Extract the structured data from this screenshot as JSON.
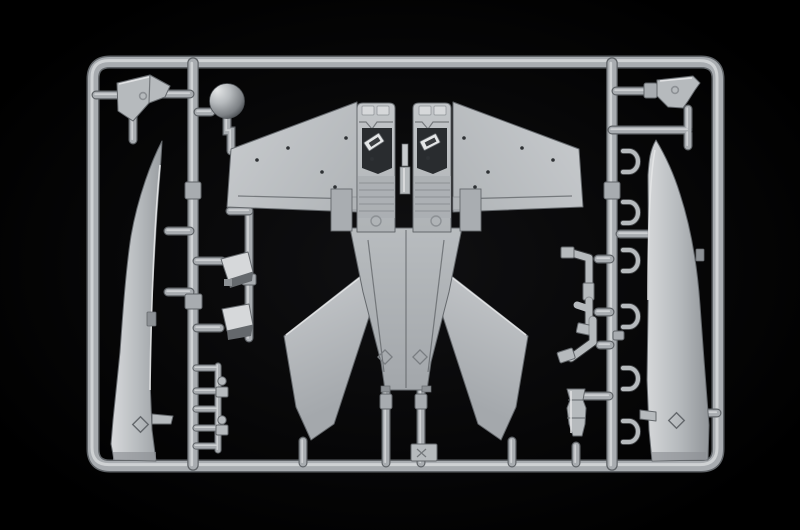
{
  "meta": {
    "title": "Model kit sprue photograph",
    "subject": "Light grey injection-moulded plastic sprue (runner frame) holding the parts of a jet-fighter model kit, photographed on a black background",
    "width_px": 800,
    "height_px": 530
  },
  "colors": {
    "background": "#000000",
    "background_center": "#101012",
    "tube_mid": "#a8acb0",
    "tube_hi": "#d3d6d8",
    "tube_dark": "#5f6367",
    "part_mid": "#b6babd",
    "part_hi": "#d6d8da",
    "part_hi2": "#e4e6e7",
    "part_sh": "#8d9195",
    "part_dark": "#64686c",
    "crevice": "#3a3d40",
    "cockpit_dark": "#292c2f",
    "dot_dark": "#2e3134"
  },
  "scene": {
    "material": "light grey polystyrene plastic",
    "backdrop": "black studio backdrop",
    "parts": [
      {
        "name": "sprue-frame",
        "description": "rounded rectangular outer runner frame"
      },
      {
        "name": "left-inner-runner",
        "description": "vertical runner bar on the left third"
      },
      {
        "name": "right-inner-runner",
        "description": "vertical runner bar on the right third"
      },
      {
        "name": "radome-ball",
        "description": "spherical nose radome part near top left"
      },
      {
        "name": "windscreen-part-left",
        "description": "angular windscreen/nose-cap part, top left"
      },
      {
        "name": "windscreen-part-right",
        "description": "angular windscreen/nose-cap part, top right"
      },
      {
        "name": "fuselage-side-left",
        "description": "long tapered fuselage side half running down the left edge"
      },
      {
        "name": "fuselage-side-right",
        "description": "long tapered fuselage side half running down the right edge"
      },
      {
        "name": "main-wing-left",
        "description": "large left wing panel of the central assembly"
      },
      {
        "name": "main-wing-right",
        "description": "large right wing panel of the central assembly"
      },
      {
        "name": "fuselage-half-left",
        "description": "central fuselage half with moulded cockpit detail"
      },
      {
        "name": "fuselage-half-right",
        "description": "central fuselage half with moulded cockpit detail"
      },
      {
        "name": "lower-fuselage",
        "description": "joined tapering rear fuselage with twin sprue stems"
      },
      {
        "name": "tail-fin-left",
        "description": "swept tail surface angled down-left"
      },
      {
        "name": "tail-fin-right",
        "description": "swept tail surface angled down-right"
      },
      {
        "name": "intake-scoop-upper",
        "description": "small box-like intake scoop part"
      },
      {
        "name": "intake-scoop-lower",
        "description": "small box-like intake scoop part"
      },
      {
        "name": "ladder-subassembly",
        "description": "ladder-like runner with five rungs and small fittings, bottom left"
      },
      {
        "name": "landing-gear-struts",
        "description": "cluster of small undercarriage strut parts left of the right runner"
      },
      {
        "name": "canopy-frame-clips",
        "description": "column of small open bracket parts on the right runner"
      },
      {
        "name": "exhaust-nozzle-part",
        "description": "small waisted nozzle part near bottom right of centre"
      },
      {
        "name": "molded-tag",
        "description": "small embossed tag plate beside the centre tail stem"
      }
    ],
    "counts": {
      "canopy_frame_clips": 6,
      "ladder_rungs": 5,
      "wing_rivet_holes_per_wing": 5,
      "embossed_diamond_marks": 4
    }
  }
}
